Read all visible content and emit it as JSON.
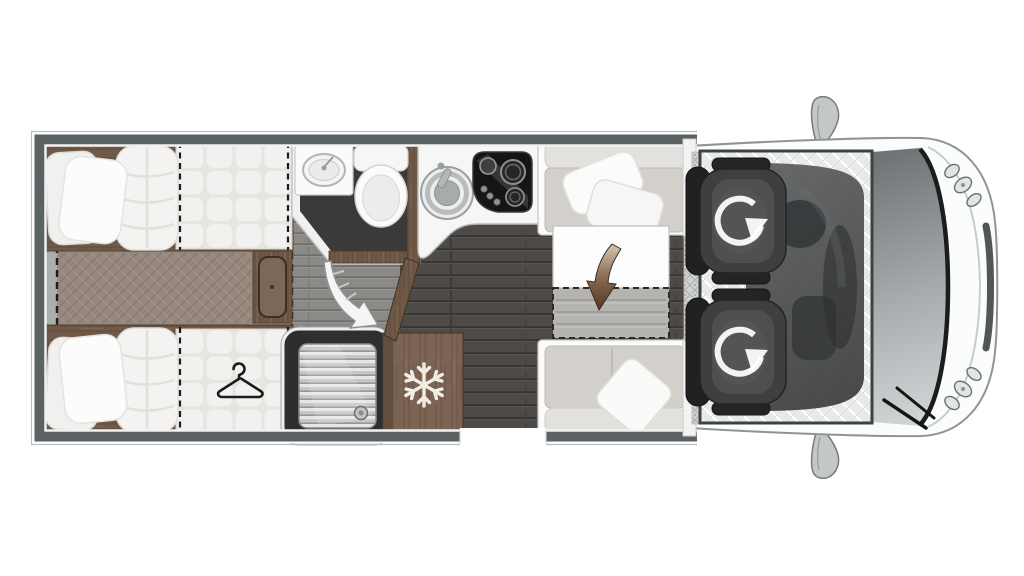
{
  "diagram": {
    "label": "Motorhome floorplan, top-down view, cab at right",
    "type": "floorplan",
    "background": "#ffffff"
  },
  "rooms": {
    "bedroom": {
      "label": "Rear bedroom with twin single beds"
    },
    "walkway": {
      "label": "Carpeted walkway between the beds"
    },
    "washroom": {
      "label": "Washroom with basin and toilet"
    },
    "shower": {
      "label": "Separate shower cubicle"
    },
    "wardrobe": {
      "label": "Wardrobe (hanger symbol)"
    },
    "fridge": {
      "label": "Fridge freezer (snowflake symbol)"
    },
    "kitchen": {
      "label": "Kitchen with round sink and hob"
    },
    "dinette": {
      "label": "Half dinette with extending table"
    },
    "entry": {
      "label": "Entrance door opening"
    },
    "cab": {
      "label": "Driver cab with two swivelling seats"
    }
  },
  "icons": {
    "snowflake": {
      "name": "snowflake-icon",
      "meaning": "fridge freezer",
      "color": "#f3ece2"
    },
    "hanger": {
      "name": "hanger-icon",
      "meaning": "wardrobe",
      "color": "#1c1c1c"
    },
    "swivel": {
      "name": "swivel-arrow-icon",
      "meaning": "cab seat rotates",
      "count": 2,
      "color": "#ffffff"
    },
    "door_swing": {
      "name": "door-swing-arrow-icon",
      "meaning": "washroom partition swing",
      "color": "#f5f5f5"
    },
    "table_extend": {
      "name": "table-extend-arrow-icon",
      "meaning": "table extension direction",
      "color": "#5a4130"
    }
  },
  "palette": {
    "wall": "#5c6263",
    "floor_main": "#4e4a47",
    "floor_hall": "#8b8a86",
    "washroom_floor": "#3a3a3a",
    "carpet": "#97887e",
    "wood": "#6e5847",
    "wood_light": "#7b6453",
    "upholstery": "#d3d0cb",
    "bedding": "#f3f3f2",
    "cab_seat": "#3d3f40",
    "vehicle_body": "#fbfcfc",
    "windshield": "#8d9295"
  }
}
